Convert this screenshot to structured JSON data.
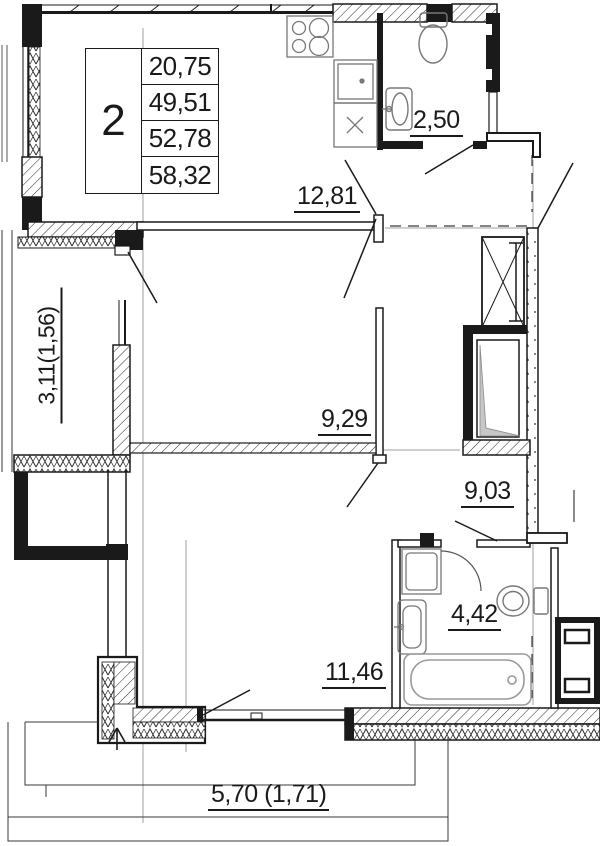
{
  "plan": {
    "title": "apartment-floor-plan",
    "table": {
      "room_count": "2",
      "values": [
        "20,75",
        "49,51",
        "52,78",
        "58,32"
      ]
    },
    "labels": {
      "wc": "2,50",
      "kitchen_living": "12,81",
      "balcony_left": "3,11(1,56)",
      "room_middle": "9,29",
      "hallway": "9,03",
      "bathroom": "4,42",
      "room_bottom": "11,46",
      "balcony_bottom": "5,70 (1,71)"
    },
    "colors": {
      "line": "#1a1a1a",
      "dimension_line": "#9f9f9f",
      "shaft_shade": "#c7c7c7"
    }
  }
}
